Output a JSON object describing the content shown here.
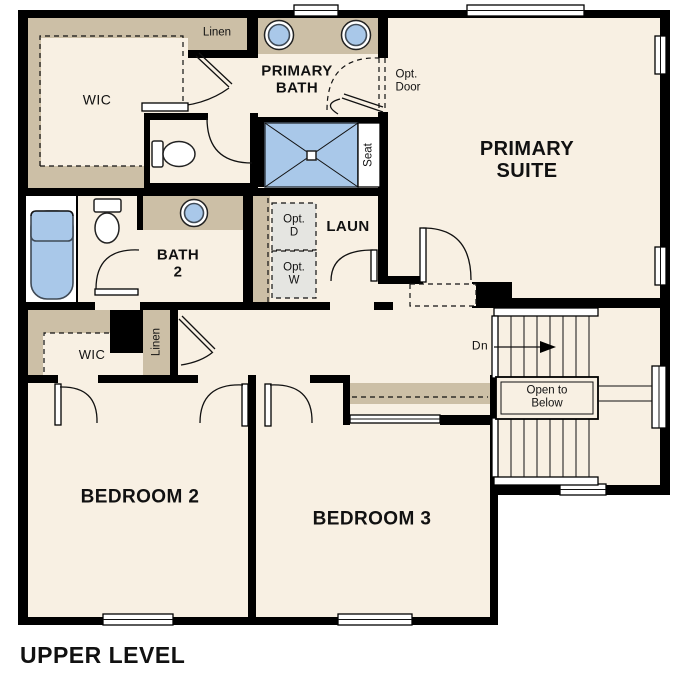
{
  "plan": {
    "title": "UPPER LEVEL",
    "labels": {
      "linen_upper": "Linen",
      "primary_bath_1": "PRIMARY",
      "primary_bath_2": "BATH",
      "opt_door_1": "Opt.",
      "opt_door_2": "Door",
      "primary_suite_1": "PRIMARY",
      "primary_suite_2": "SUITE",
      "wic_primary": "WIC",
      "seat": "Seat",
      "laundry": "LAUN",
      "opt_dryer_1": "Opt.",
      "opt_dryer_2": "D",
      "opt_washer_1": "Opt.",
      "opt_washer_2": "W",
      "bath2_1": "BATH",
      "bath2_2": "2",
      "wic_secondary": "WIC",
      "linen_hall": "Linen",
      "stairs_down": "Dn",
      "open_below_1": "Open to",
      "open_below_2": "Below",
      "bedroom2": "BEDROOM 2",
      "bedroom3": "BEDROOM 3"
    },
    "colors": {
      "floor": "#f8f0e3",
      "wall": "#000000",
      "cabinet_tan": "#ccbfa6",
      "fixture_blue": "#a9c8e9",
      "optional_gray": "#e5e5e1"
    }
  }
}
